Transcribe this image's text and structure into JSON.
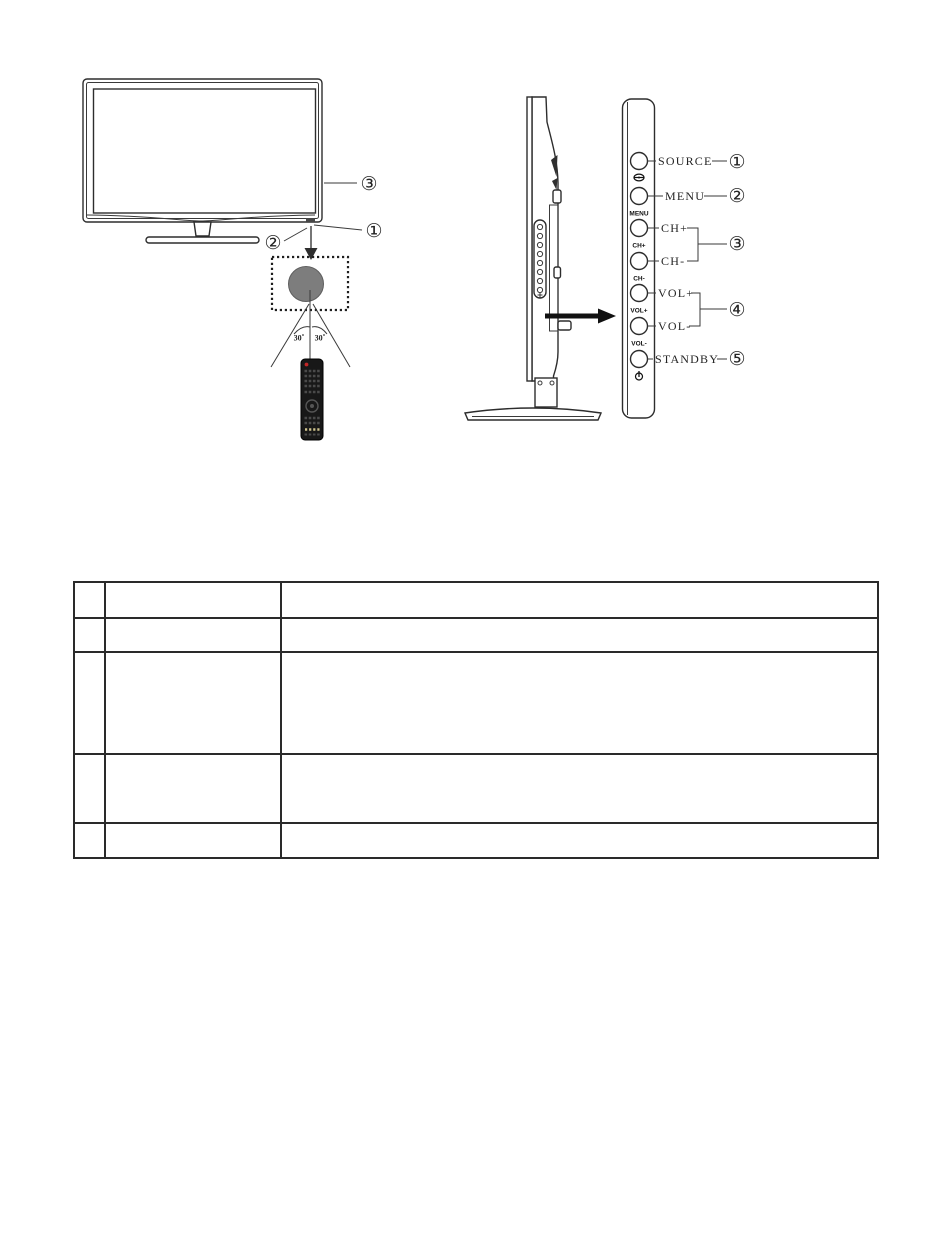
{
  "front_view": {
    "callout_bezel": "③",
    "callout_ir_sensor": "①",
    "callout_speaker": "②",
    "angle_left": "30˚",
    "angle_right": "30˚"
  },
  "side_panel": {
    "buttons": [
      {
        "id": "source",
        "label": "SOURCE",
        "strip_label": ""
      },
      {
        "id": "menu",
        "label": "MENU",
        "strip_label": "MENU"
      },
      {
        "id": "ch-plus",
        "label": "CH+",
        "strip_label": "CH+"
      },
      {
        "id": "ch-minus",
        "label": "CH-",
        "strip_label": "CH-"
      },
      {
        "id": "vol-plus",
        "label": "VOL+",
        "strip_label": "VOL+"
      },
      {
        "id": "vol-minus",
        "label": "VOL-",
        "strip_label": "VOL-"
      },
      {
        "id": "standby",
        "label": "STANDBY",
        "strip_label": ""
      }
    ],
    "callout_source": "①",
    "callout_menu": "②",
    "callout_channel": "③",
    "callout_volume": "④",
    "callout_standby": "⑤",
    "icons": {
      "source": "source-input-icon",
      "power": "power-standby-icon"
    }
  },
  "parts_table": {
    "rows": [
      [
        "",
        "",
        ""
      ],
      [
        "",
        "",
        ""
      ],
      [
        "",
        "",
        ""
      ],
      [
        "",
        "",
        ""
      ],
      [
        "",
        "",
        ""
      ]
    ]
  },
  "colors": {
    "ink": "#2d2d2d",
    "ir_circle_fill": "#7d7d7d",
    "remote_body": "#181818",
    "remote_power_button": "#c22727"
  }
}
